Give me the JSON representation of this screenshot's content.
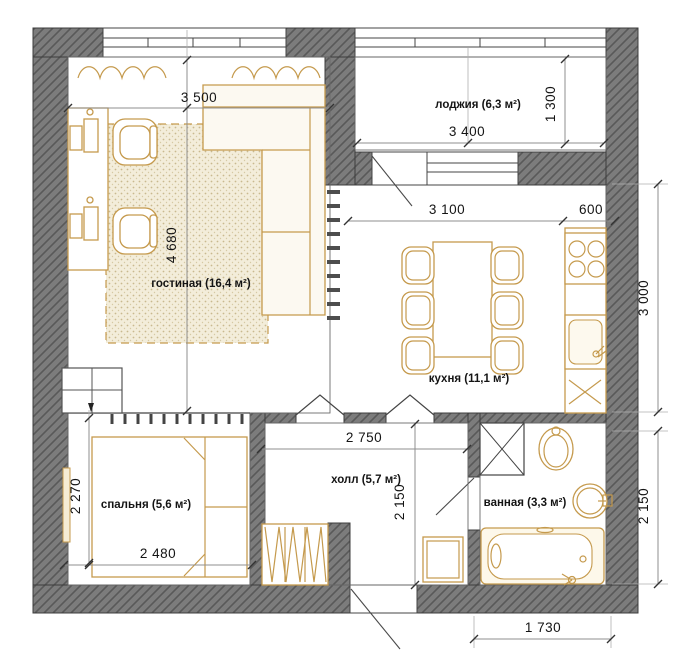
{
  "rooms": [
    {
      "id": "living",
      "label": "гостиная (16,4 м²)"
    },
    {
      "id": "loggia",
      "label": "лоджия (6,3 м²)"
    },
    {
      "id": "kitchen",
      "label": "кухня (11,1 м²)"
    },
    {
      "id": "bedroom",
      "label": "спальня (5,6 м²)"
    },
    {
      "id": "hall",
      "label": "холл (5,7 м²)"
    },
    {
      "id": "bathroom",
      "label": "ванная (3,3 м²)"
    }
  ],
  "dims": {
    "living_width": "3 500",
    "living_depth": "4 680",
    "loggia_width": "3 400",
    "loggia_depth": "1 300",
    "kitchen_width": "3 100",
    "counter_depth": "600",
    "kitchen_depth": "3 000",
    "bedroom_depth": "2 270",
    "bedroom_width": "2 480",
    "hall_width": "2 750",
    "hall_depth": "2 150",
    "bathroom_depth": "2 150",
    "bathroom_width": "1 730"
  },
  "colors": {
    "wall_fill": "#7c7c7c",
    "wall_hatch": "#595959",
    "furniture_accent": "#c59a4d",
    "rug_dot": "#c9b98e"
  }
}
